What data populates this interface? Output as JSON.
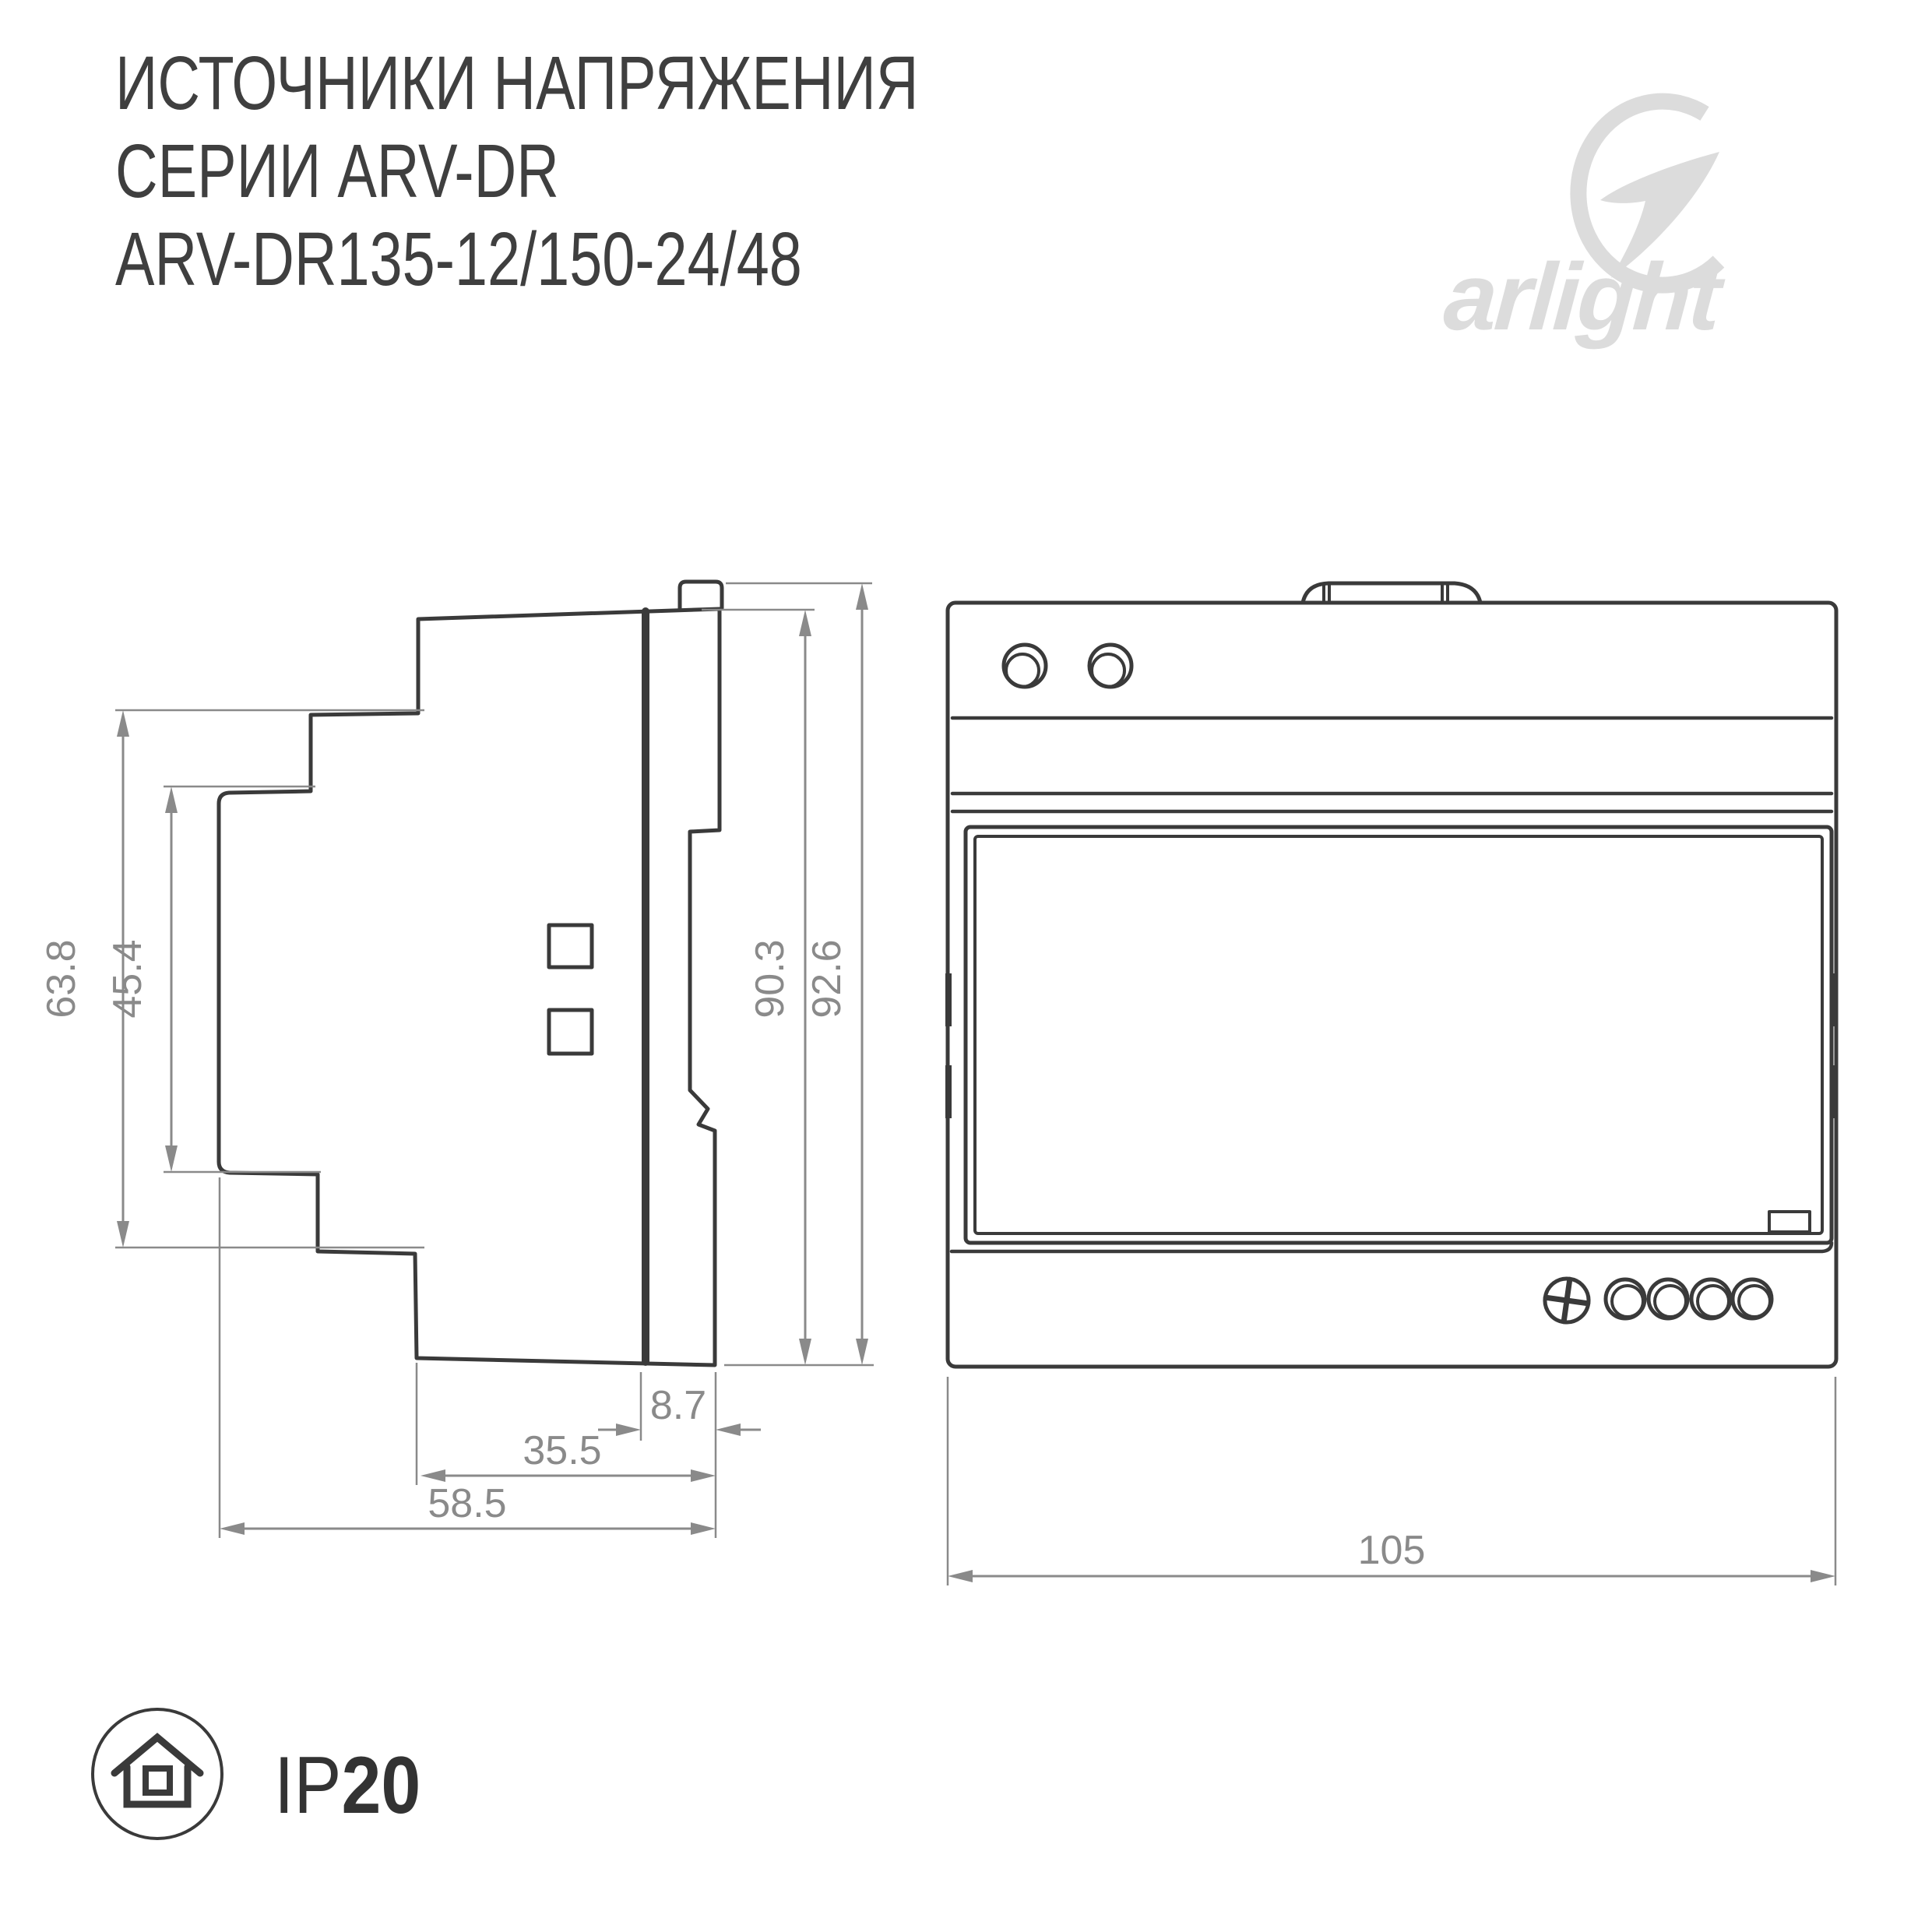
{
  "title": {
    "line1": "ИСТОЧНИКИ НАПРЯЖЕНИЯ",
    "line2": "СЕРИИ ARV-DR",
    "line3": "ARV-DR135-12/150-24/48"
  },
  "logo": {
    "brand": "arlight",
    "color": "#dcdcdc"
  },
  "drawing": {
    "type": "dimensioned-technical-drawing",
    "views": [
      "side-view",
      "front-view"
    ],
    "units": "mm",
    "dimensions": {
      "side": [
        {
          "name": "body-left-height",
          "value": "63.8",
          "orientation": "vertical"
        },
        {
          "name": "recess-height",
          "value": "45.4",
          "orientation": "vertical"
        },
        {
          "name": "case-height",
          "value": "90.3",
          "orientation": "vertical"
        },
        {
          "name": "total-height",
          "value": "92.6",
          "orientation": "vertical"
        },
        {
          "name": "din-plate-depth",
          "value": "8.7",
          "orientation": "horizontal"
        },
        {
          "name": "body-depth",
          "value": "35.5",
          "orientation": "horizontal"
        },
        {
          "name": "total-depth",
          "value": "58.5",
          "orientation": "horizontal"
        }
      ],
      "front": [
        {
          "name": "total-width",
          "value": "105",
          "orientation": "horizontal"
        }
      ]
    }
  },
  "badge": {
    "icon": "house-in-circle",
    "ip_prefix": "IP",
    "ip_value": "20"
  },
  "colors": {
    "line": "#3a3a3a",
    "dimension": "#8a8a8a",
    "logo": "#dcdcdc",
    "background": "#ffffff"
  }
}
